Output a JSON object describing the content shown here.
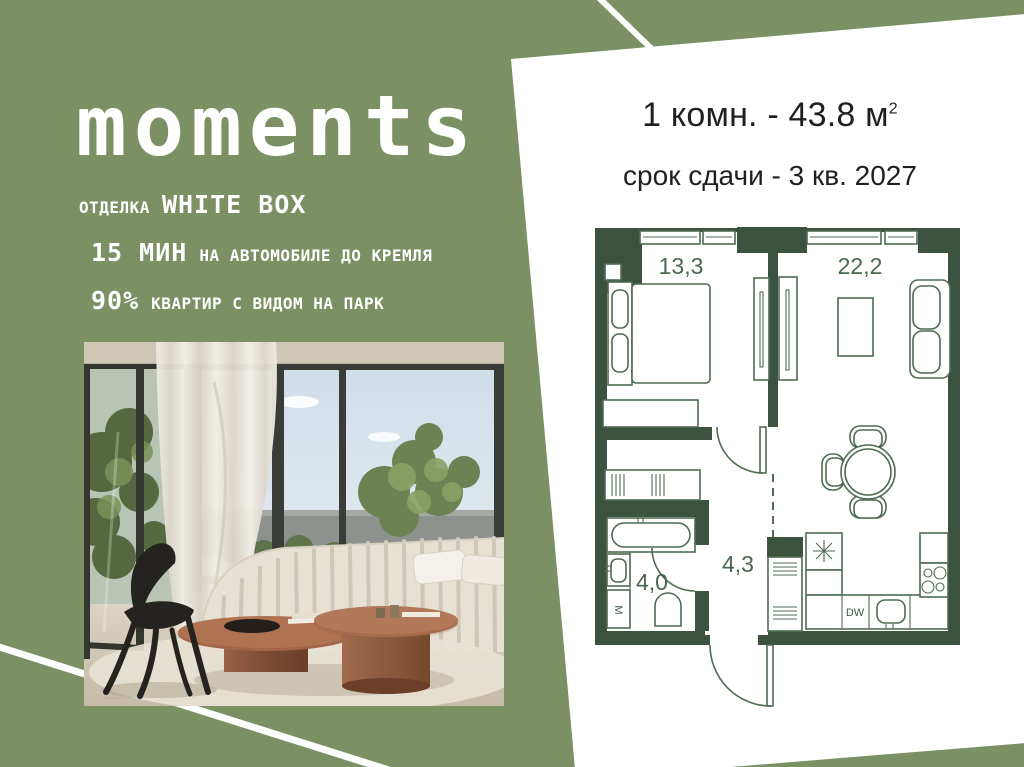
{
  "brand": {
    "logo": "moments"
  },
  "left_panel": {
    "features": [
      {
        "small_before": "ОТДЕЛКА",
        "big": "WHITE BOX",
        "small_after": ""
      },
      {
        "small_before": "",
        "big": "15 МИН",
        "small_after": "НА АВТОМОБИЛЕ ДО КРЕМЛЯ"
      },
      {
        "small_before": "",
        "big": "90%",
        "small_after": "КВАРТИР С ВИДОМ НА ПАРК"
      }
    ]
  },
  "right_panel": {
    "headline": {
      "text": "1 комн. - 43.8 м",
      "sup": "2"
    },
    "deadline": "срок сдачи - 3 кв. 2027"
  },
  "floor_plan": {
    "labels": {
      "bedroom": "13,3",
      "living": "22,2",
      "bathroom": "4,0",
      "hallway": "4,3",
      "dishwasher": "DW",
      "washer": "M"
    }
  },
  "colors": {
    "background_green": "#7b9163",
    "panel_white": "#ffffff",
    "plan_walls": "#3b523e",
    "plan_lines": "#4e6b53",
    "text_dark": "#1f1f1f",
    "text_light": "#ffffff"
  }
}
